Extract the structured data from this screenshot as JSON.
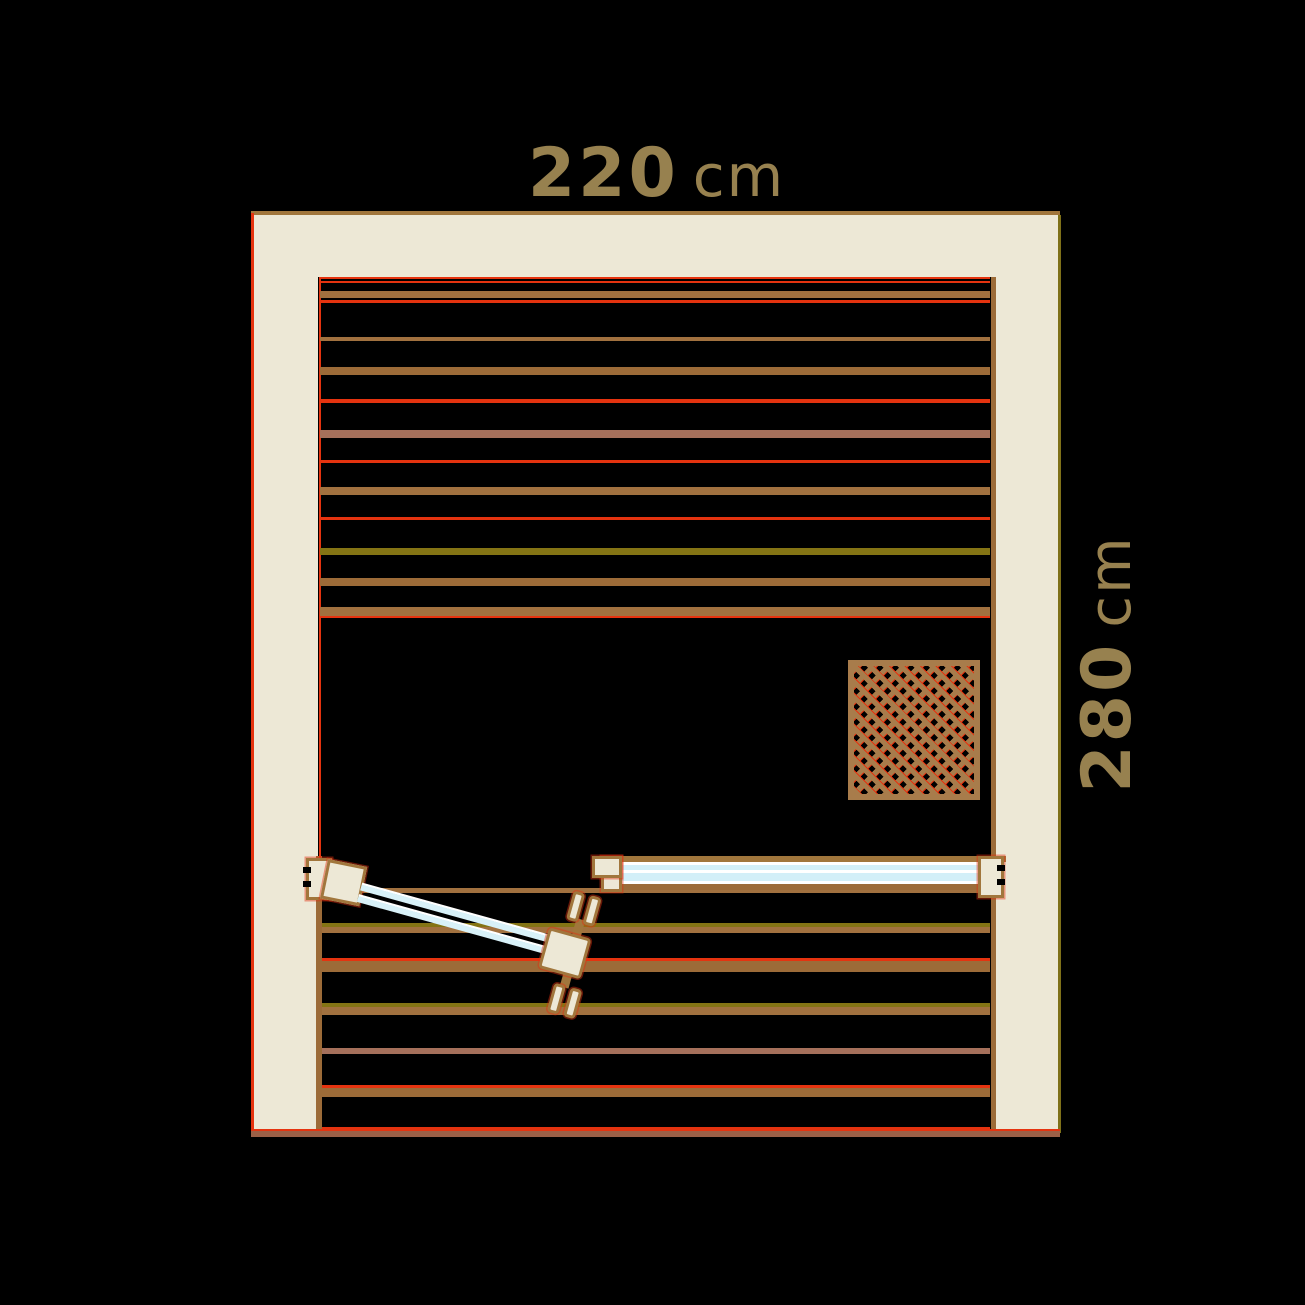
{
  "dimensions": {
    "width": {
      "value": "220",
      "unit": "cm"
    },
    "height": {
      "value": "280",
      "unit": "cm"
    }
  },
  "colors": {
    "background": "#000000",
    "wall_cream": "#EDE8D6",
    "frame_brown": "#A1763C",
    "outline_red": "#E5330F",
    "slat_brown": "#A1713F",
    "slat_brown_dark": "#9C6B38",
    "slat_mauve": "#A5705B",
    "slat_olive": "#847414",
    "glass_blue": "#D2EFF8",
    "glass_white": "#FFFFFF",
    "lattice_brown": "#A87C4B",
    "label_tan": "#97814F",
    "base_brown": "#9B6047"
  },
  "figure": {
    "wall_slats": {
      "x": 320,
      "w": 670,
      "bands": [
        {
          "y": 277,
          "h": 2,
          "c": "outline_red"
        },
        {
          "y": 281,
          "h": 2,
          "c": "outline_red"
        },
        {
          "y": 291,
          "h": 7,
          "c": "slat_brown"
        },
        {
          "y": 300,
          "h": 3,
          "c": "outline_red"
        },
        {
          "y": 337,
          "h": 4,
          "c": "slat_brown"
        },
        {
          "y": 367,
          "h": 8,
          "c": "slat_brown_dark"
        },
        {
          "y": 399,
          "h": 4,
          "c": "outline_red"
        },
        {
          "y": 430,
          "h": 8,
          "c": "slat_mauve"
        },
        {
          "y": 460,
          "h": 3,
          "c": "outline_red"
        },
        {
          "y": 487,
          "h": 8,
          "c": "slat_brown"
        },
        {
          "y": 517,
          "h": 3,
          "c": "outline_red"
        },
        {
          "y": 548,
          "h": 7,
          "c": "slat_olive"
        },
        {
          "y": 578,
          "h": 8,
          "c": "slat_brown_dark"
        },
        {
          "y": 607,
          "h": 10,
          "c": "slat_brown"
        },
        {
          "y": 616,
          "h": 2,
          "c": "outline_red"
        }
      ]
    },
    "terrace_slats": {
      "x": 322,
      "w": 668,
      "bands": [
        {
          "y": 888,
          "h": 5,
          "c": "slat_brown"
        },
        {
          "y": 923,
          "h": 4,
          "c": "slat_olive"
        },
        {
          "y": 927,
          "h": 6,
          "c": "slat_brown"
        },
        {
          "y": 958,
          "h": 3,
          "c": "outline_red"
        },
        {
          "y": 961,
          "h": 11,
          "c": "slat_brown_dark"
        },
        {
          "y": 1003,
          "h": 4,
          "c": "slat_olive"
        },
        {
          "y": 1007,
          "h": 8,
          "c": "slat_brown"
        },
        {
          "y": 1048,
          "h": 6,
          "c": "slat_mauve"
        },
        {
          "y": 1085,
          "h": 3,
          "c": "outline_red"
        },
        {
          "y": 1088,
          "h": 9,
          "c": "slat_brown_dark"
        },
        {
          "y": 1127,
          "h": 3,
          "c": "outline_red"
        }
      ]
    },
    "heater_lattice": {
      "x": 848,
      "y": 660,
      "w": 132,
      "h": 140
    }
  }
}
